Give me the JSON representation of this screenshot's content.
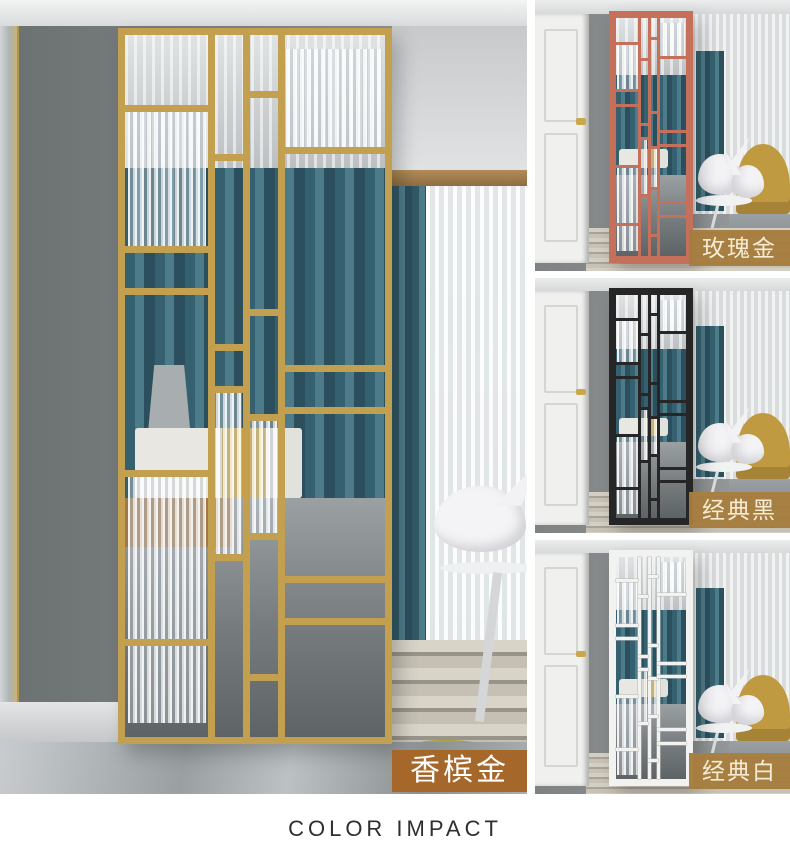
{
  "caption": "COLOR IMPACT",
  "main_product": {
    "label": "香槟金",
    "name": "champagne-gold"
  },
  "variants": [
    {
      "label": "玫瑰金",
      "name": "rose-gold"
    },
    {
      "label": "经典黑",
      "name": "classic-black"
    },
    {
      "label": "经典白",
      "name": "classic-white"
    }
  ],
  "colors": {
    "champagne_gold": "#c3a04f",
    "rose_gold": "#c4705a",
    "classic_black": "#262626",
    "classic_white": "#f2f2f0",
    "teal_curtain": "#406d7c",
    "main_badge_bg": "#a5672a",
    "variant_badge_bg": "#a67d3e",
    "badge_text": "#f8eed6",
    "caption_text": "#2f2f2f"
  }
}
